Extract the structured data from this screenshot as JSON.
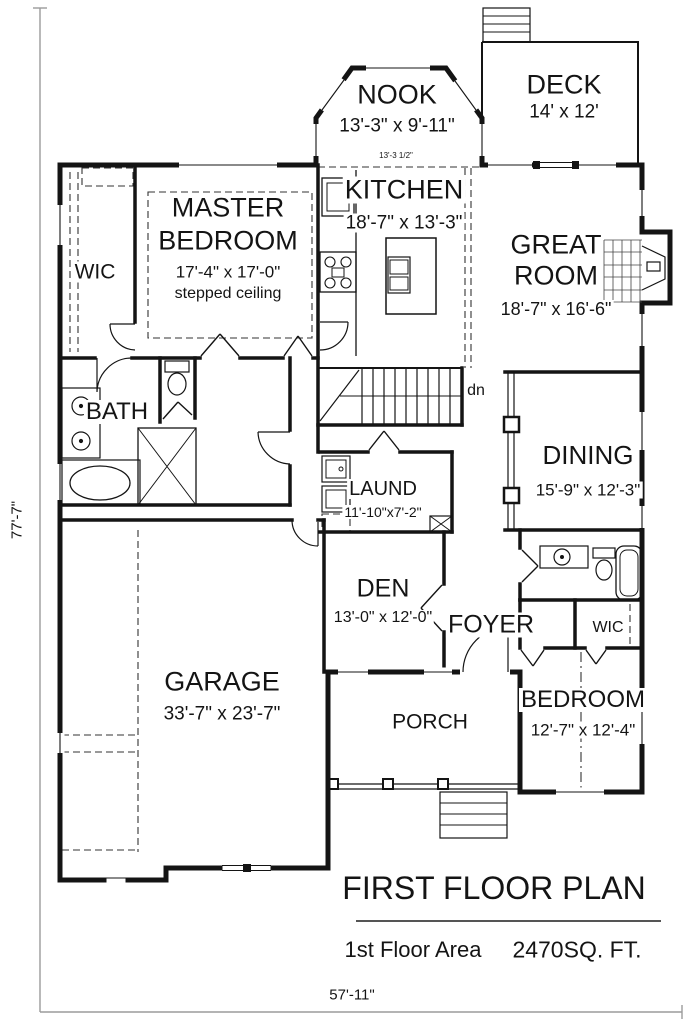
{
  "colors": {
    "ink": "#141414",
    "dimension_line": "#9b9b9b"
  },
  "plan": {
    "rooms": {
      "nook": {
        "name": "NOOK",
        "size": "13'-3\" x 9'-11\""
      },
      "deck": {
        "name": "DECK",
        "size": "14' x 12'"
      },
      "kitchen": {
        "name": "KITCHEN",
        "size": "18'-7\" x 13'-3\"",
        "note": "13'-3 1/2\""
      },
      "great_room": {
        "name_line1": "GREAT",
        "name_line2": "ROOM",
        "size": "18'-7\" x 16'-6\""
      },
      "master_bedroom": {
        "name_line1": "MASTER",
        "name_line2": "BEDROOM",
        "size": "17'-4\" x 17'-0\"",
        "note": "stepped ceiling"
      },
      "wic_master": {
        "name": "WIC"
      },
      "bath": {
        "name": "BATH"
      },
      "dining": {
        "name": "DINING",
        "size": "15'-9\" x 12'-3\""
      },
      "laundry": {
        "name": "LAUND",
        "size": "11'-10\"x7'-2\""
      },
      "den": {
        "name": "DEN",
        "size": "13'-0\" x 12'-0\""
      },
      "foyer": {
        "name": "FOYER"
      },
      "wic_bedroom": {
        "name": "WIC"
      },
      "garage": {
        "name": "GARAGE",
        "size": "33'-7\" x 23'-7\""
      },
      "porch": {
        "name": "PORCH"
      },
      "bedroom": {
        "name": "BEDROOM",
        "size": "12'-7\" x 12'-4\""
      }
    },
    "annotations": {
      "stairs_down": "dn"
    },
    "dimensions": {
      "overall_depth": "77'-7\"",
      "overall_width": "57'-11\""
    },
    "title_block": {
      "title": "FIRST FLOOR PLAN",
      "area_label": "1st Floor Area",
      "area_value": "2470SQ. FT."
    }
  }
}
